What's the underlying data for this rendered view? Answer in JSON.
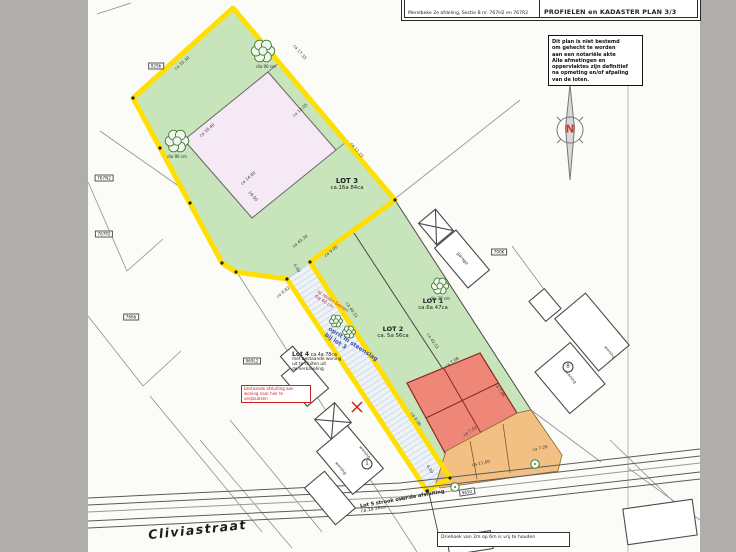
{
  "title_block": {
    "kadaster_label": "Kadaster:",
    "kadaster_value": "Merelbeke 2e afdeling, Sectie B nr. 767H2 en 767R2",
    "top_left": "NIEUWE TOESTAND",
    "top_right": "PLAN 2/3",
    "plan_title": "PROFIELEN en KADASTER PLAN 3/3"
  },
  "note_box": {
    "lines": [
      "Dit plan is niet bestemd",
      "om gehecht te worden",
      "aan een notariële akte",
      "Alle afmetingen en",
      "oppervlaktes zijn definitief",
      "na opmeting en/of afpaling",
      "van de loten."
    ]
  },
  "north_label": "N",
  "street_name": "Cliviastraat",
  "lots": {
    "lot1_name": "LOT 1",
    "lot1_area": "ca.6a 47ca",
    "lot2_name": "LOT 2",
    "lot2_area": "ca. 5a 56ca",
    "lot3_name": "LOT 3",
    "lot3_area": "ca.16a 84ca",
    "lot4_name": "Lot 4",
    "lot4_area": "ca.4a 78ca",
    "lot4_note": [
      "met bestaande woning",
      "uit te sluiten uit",
      "de verkaveling"
    ],
    "lot5_line1": "Lot 5 strook over de afsluiting",
    "lot5_line2": "ca.1a 30ca"
  },
  "annotations": {
    "oprit_line1": "oprit in steenslag",
    "oprit_line2": "bij lot 3",
    "rooien_line1": "te rooien bomen",
    "rooien_line2": "dia 60 cm",
    "red_note_lines": [
      "bestaande afsluiting aan",
      "woning naar hier te",
      "verplaatsen"
    ],
    "driehoek_note": "Driehoek van 2m op 6m is vrij te houden",
    "garage_label": "garage"
  },
  "building_labels": [
    {
      "x": 365,
      "y": 452,
      "rot": 50,
      "text": "woning"
    },
    {
      "x": 341,
      "y": 468,
      "rot": 50,
      "text": "woning"
    },
    {
      "x": 610,
      "y": 352,
      "rot": 50,
      "text": "woning"
    },
    {
      "x": 571,
      "y": 377,
      "rot": 50,
      "text": "woning"
    }
  ],
  "circled_numbers": [
    {
      "x": 367,
      "y": 464,
      "text": "1"
    },
    {
      "x": 568,
      "y": 367,
      "text": "8"
    }
  ],
  "parcel_labels": [
    {
      "x": 156,
      "y": 66,
      "rot": 0,
      "text": "929b"
    },
    {
      "x": 104,
      "y": 178,
      "rot": 0,
      "text": "767N2"
    },
    {
      "x": 104,
      "y": 234,
      "rot": 0,
      "text": "767P2"
    },
    {
      "x": 131,
      "y": 317,
      "rot": 0,
      "text": "766b"
    },
    {
      "x": 252,
      "y": 361,
      "rot": 0,
      "text": "969L2"
    },
    {
      "x": 499,
      "y": 252,
      "rot": 0,
      "text": "790K"
    },
    {
      "x": 467,
      "y": 492,
      "rot": -9,
      "text": "9692"
    }
  ],
  "dimensions": [
    {
      "x": 182,
      "y": 63,
      "rot": -41,
      "text": "ca 33.30"
    },
    {
      "x": 300,
      "y": 52,
      "rot": 50,
      "text": "ca 17.35"
    },
    {
      "x": 357,
      "y": 150,
      "rot": 50,
      "text": "ca 11.15"
    },
    {
      "x": 300,
      "y": 241,
      "rot": -38,
      "text": "ca 40.36"
    },
    {
      "x": 253,
      "y": 196,
      "rot": 50,
      "text": "19.00"
    },
    {
      "x": 207,
      "y": 130,
      "rot": -41,
      "text": "ca 16.40"
    },
    {
      "x": 300,
      "y": 110,
      "rot": -41,
      "text": "ca 13.05"
    },
    {
      "x": 248,
      "y": 178,
      "rot": -41,
      "text": "ca 14.80"
    },
    {
      "x": 331,
      "y": 251,
      "rot": -38,
      "text": "ca 9.00"
    },
    {
      "x": 297,
      "y": 268,
      "rot": 56,
      "text": "4.00"
    },
    {
      "x": 352,
      "y": 310,
      "rot": 56,
      "text": "ca 40.51"
    },
    {
      "x": 433,
      "y": 341,
      "rot": 56,
      "text": "ca 43.51"
    },
    {
      "x": 452,
      "y": 362,
      "rot": -34,
      "text": "ca 7.06"
    },
    {
      "x": 500,
      "y": 390,
      "rot": 56,
      "text": "ca 7.06"
    },
    {
      "x": 470,
      "y": 431,
      "rot": -34,
      "text": "ca 7.02"
    },
    {
      "x": 481,
      "y": 463,
      "rot": -12,
      "text": "ca 11.60"
    },
    {
      "x": 540,
      "y": 448,
      "rot": -12,
      "text": "ca 7.26"
    },
    {
      "x": 430,
      "y": 469,
      "rot": 56,
      "text": "4.00"
    },
    {
      "x": 283,
      "y": 292,
      "rot": -38,
      "text": "ca 6.82"
    },
    {
      "x": 416,
      "y": 419,
      "rot": 56,
      "text": "ca 9.00"
    },
    {
      "x": 404,
      "y": 498,
      "rot": -10,
      "text": "18.36"
    }
  ],
  "trees": [
    {
      "x": 263,
      "y": 51,
      "r": 11,
      "label": "dia 90 cm",
      "lx": 266,
      "ly": 64
    },
    {
      "x": 177,
      "y": 141,
      "r": 11,
      "label": "dia 90 cm",
      "lx": 177,
      "ly": 154
    },
    {
      "x": 440,
      "y": 286,
      "r": 8,
      "label": "dia 30 cm",
      "lx": 440,
      "ly": 296
    },
    {
      "x": 336,
      "y": 321,
      "r": 6,
      "label": "",
      "lx": 0,
      "ly": 0
    },
    {
      "x": 349,
      "y": 332,
      "r": 6,
      "label": "",
      "lx": 0,
      "ly": 0
    }
  ],
  "street_trees": [
    {
      "x": 455,
      "y": 487
    },
    {
      "x": 535,
      "y": 464
    }
  ],
  "survey_dots": [
    [
      133,
      98
    ],
    [
      160,
      148
    ],
    [
      190,
      203
    ],
    [
      222,
      263
    ],
    [
      236,
      272
    ],
    [
      287,
      279
    ],
    [
      310,
      262
    ],
    [
      395,
      200
    ],
    [
      450,
      478
    ],
    [
      427,
      491
    ]
  ],
  "colors": {
    "boundary_yellow": "#ffdf00",
    "parcel_green": "#c8e4ba",
    "building_pink": "#f4e9f5",
    "building_red": "#ee8777",
    "zone_orange": "#f3c083",
    "annotation_red": "#cc2020",
    "annotation_blue": "#3a50b0"
  }
}
